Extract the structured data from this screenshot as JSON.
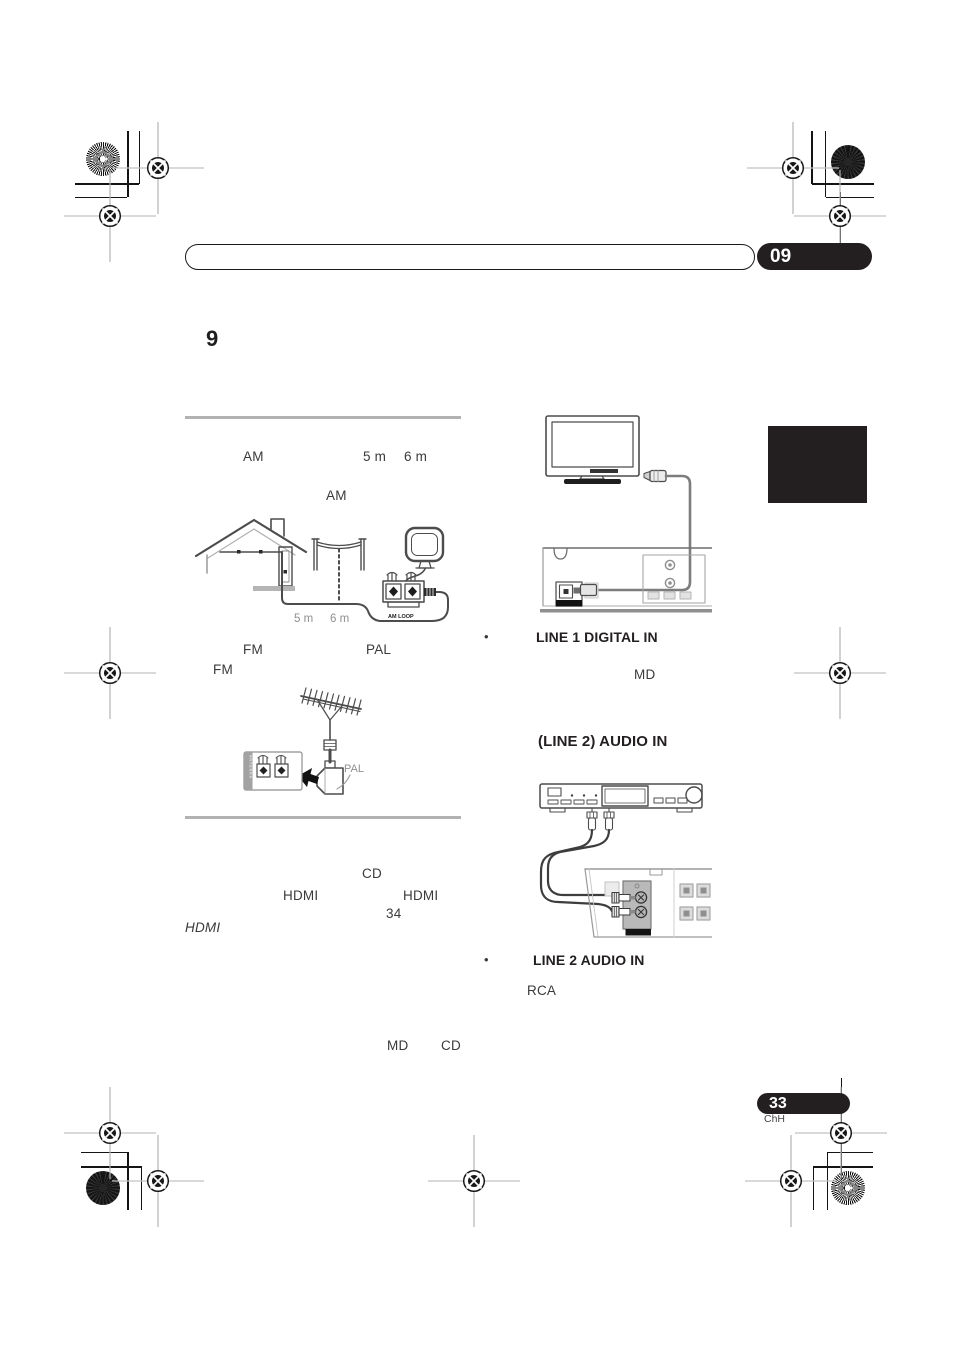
{
  "page": {
    "chapter_badge": "09",
    "section_number": "9",
    "page_number": "33",
    "region_code": "ChH"
  },
  "left_column": {
    "row1": {
      "am": "AM",
      "d5": "5 m",
      "d6": "6 m"
    },
    "row2": {
      "am": "AM"
    },
    "am_diagram": {
      "d5": "5 m",
      "d6": "6 m",
      "terminal_label": "AM LOOP"
    },
    "row3": {
      "fm": "FM",
      "pal": "PAL"
    },
    "row4": {
      "fm": "FM"
    },
    "fm_diagram": {
      "pal_label": "PAL",
      "panel_label": "ANTENNA"
    },
    "row5": {
      "cd": "CD"
    },
    "row6": {
      "hdmi_a": "HDMI",
      "hdmi_b": "HDMI"
    },
    "row7": {
      "page_ref": "34"
    },
    "row8": {
      "hdmi": "HDMI"
    },
    "row9": {
      "md": "MD",
      "cd": "CD"
    }
  },
  "right_column": {
    "item1": {
      "bullet": "•",
      "label": "LINE 1 DIGITAL IN"
    },
    "row_md": {
      "md": "MD"
    },
    "subheading": {
      "label": "(LINE 2) AUDIO IN"
    },
    "item2": {
      "bullet": "•",
      "label": "LINE 2 AUDIO IN"
    },
    "row_rca": {
      "rca": "RCA"
    }
  },
  "colors": {
    "ink": "#231f20",
    "divider": "#b2b2b2",
    "muted_gray": "#8f8f8f"
  }
}
